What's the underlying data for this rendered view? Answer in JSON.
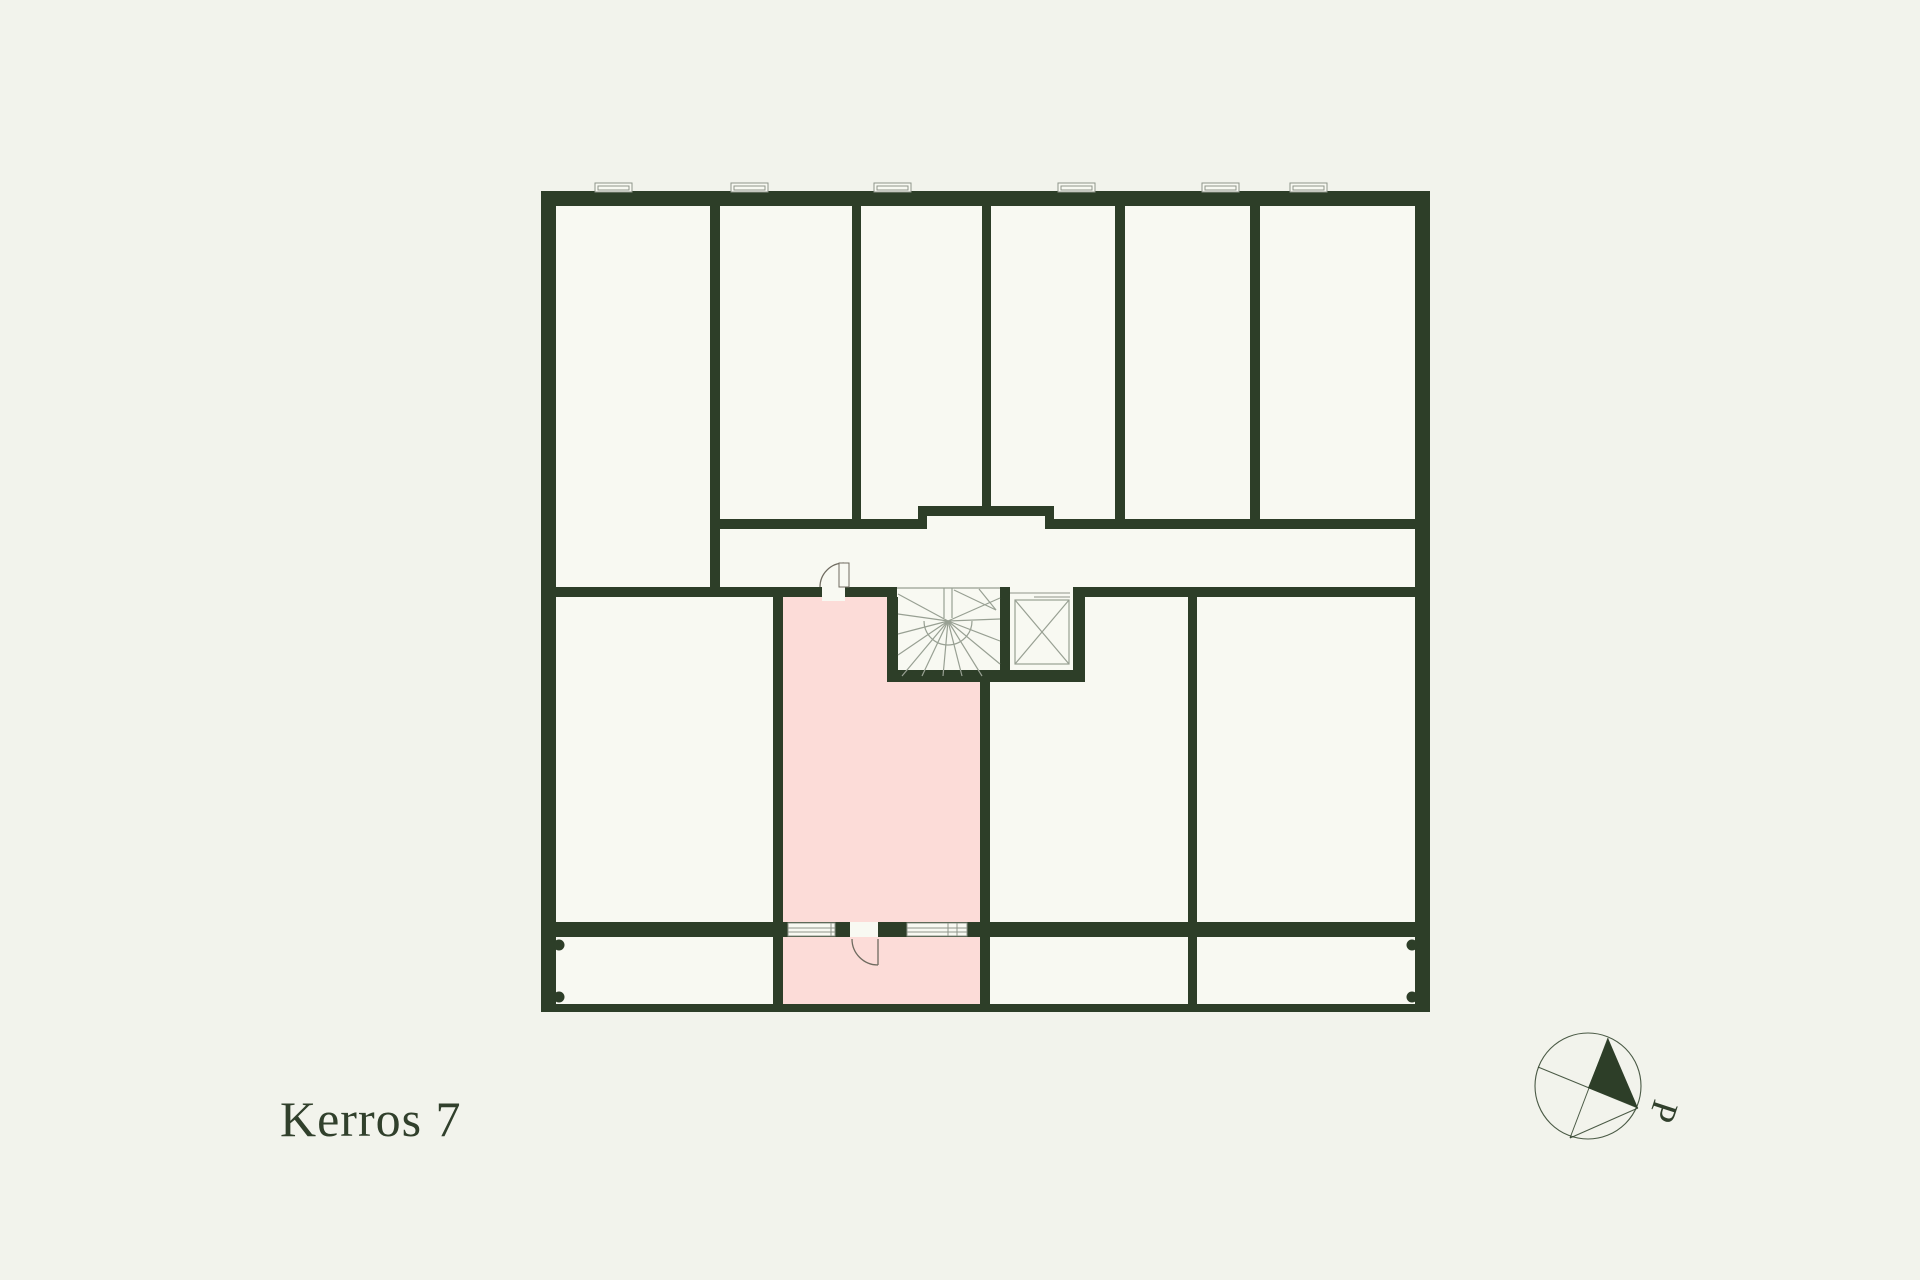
{
  "page": {
    "floor_label": "Kerros 7"
  },
  "compass": {
    "north_label": "P"
  },
  "theme": {
    "page_bg": "#f2f3ec",
    "room": "#f8f9f2",
    "wall": "#2d3e28",
    "highlight": "#fcdcd8",
    "line": "#98a093",
    "door": "#6f6b60",
    "window_outline": "#8f958a",
    "text": "#31402c"
  }
}
